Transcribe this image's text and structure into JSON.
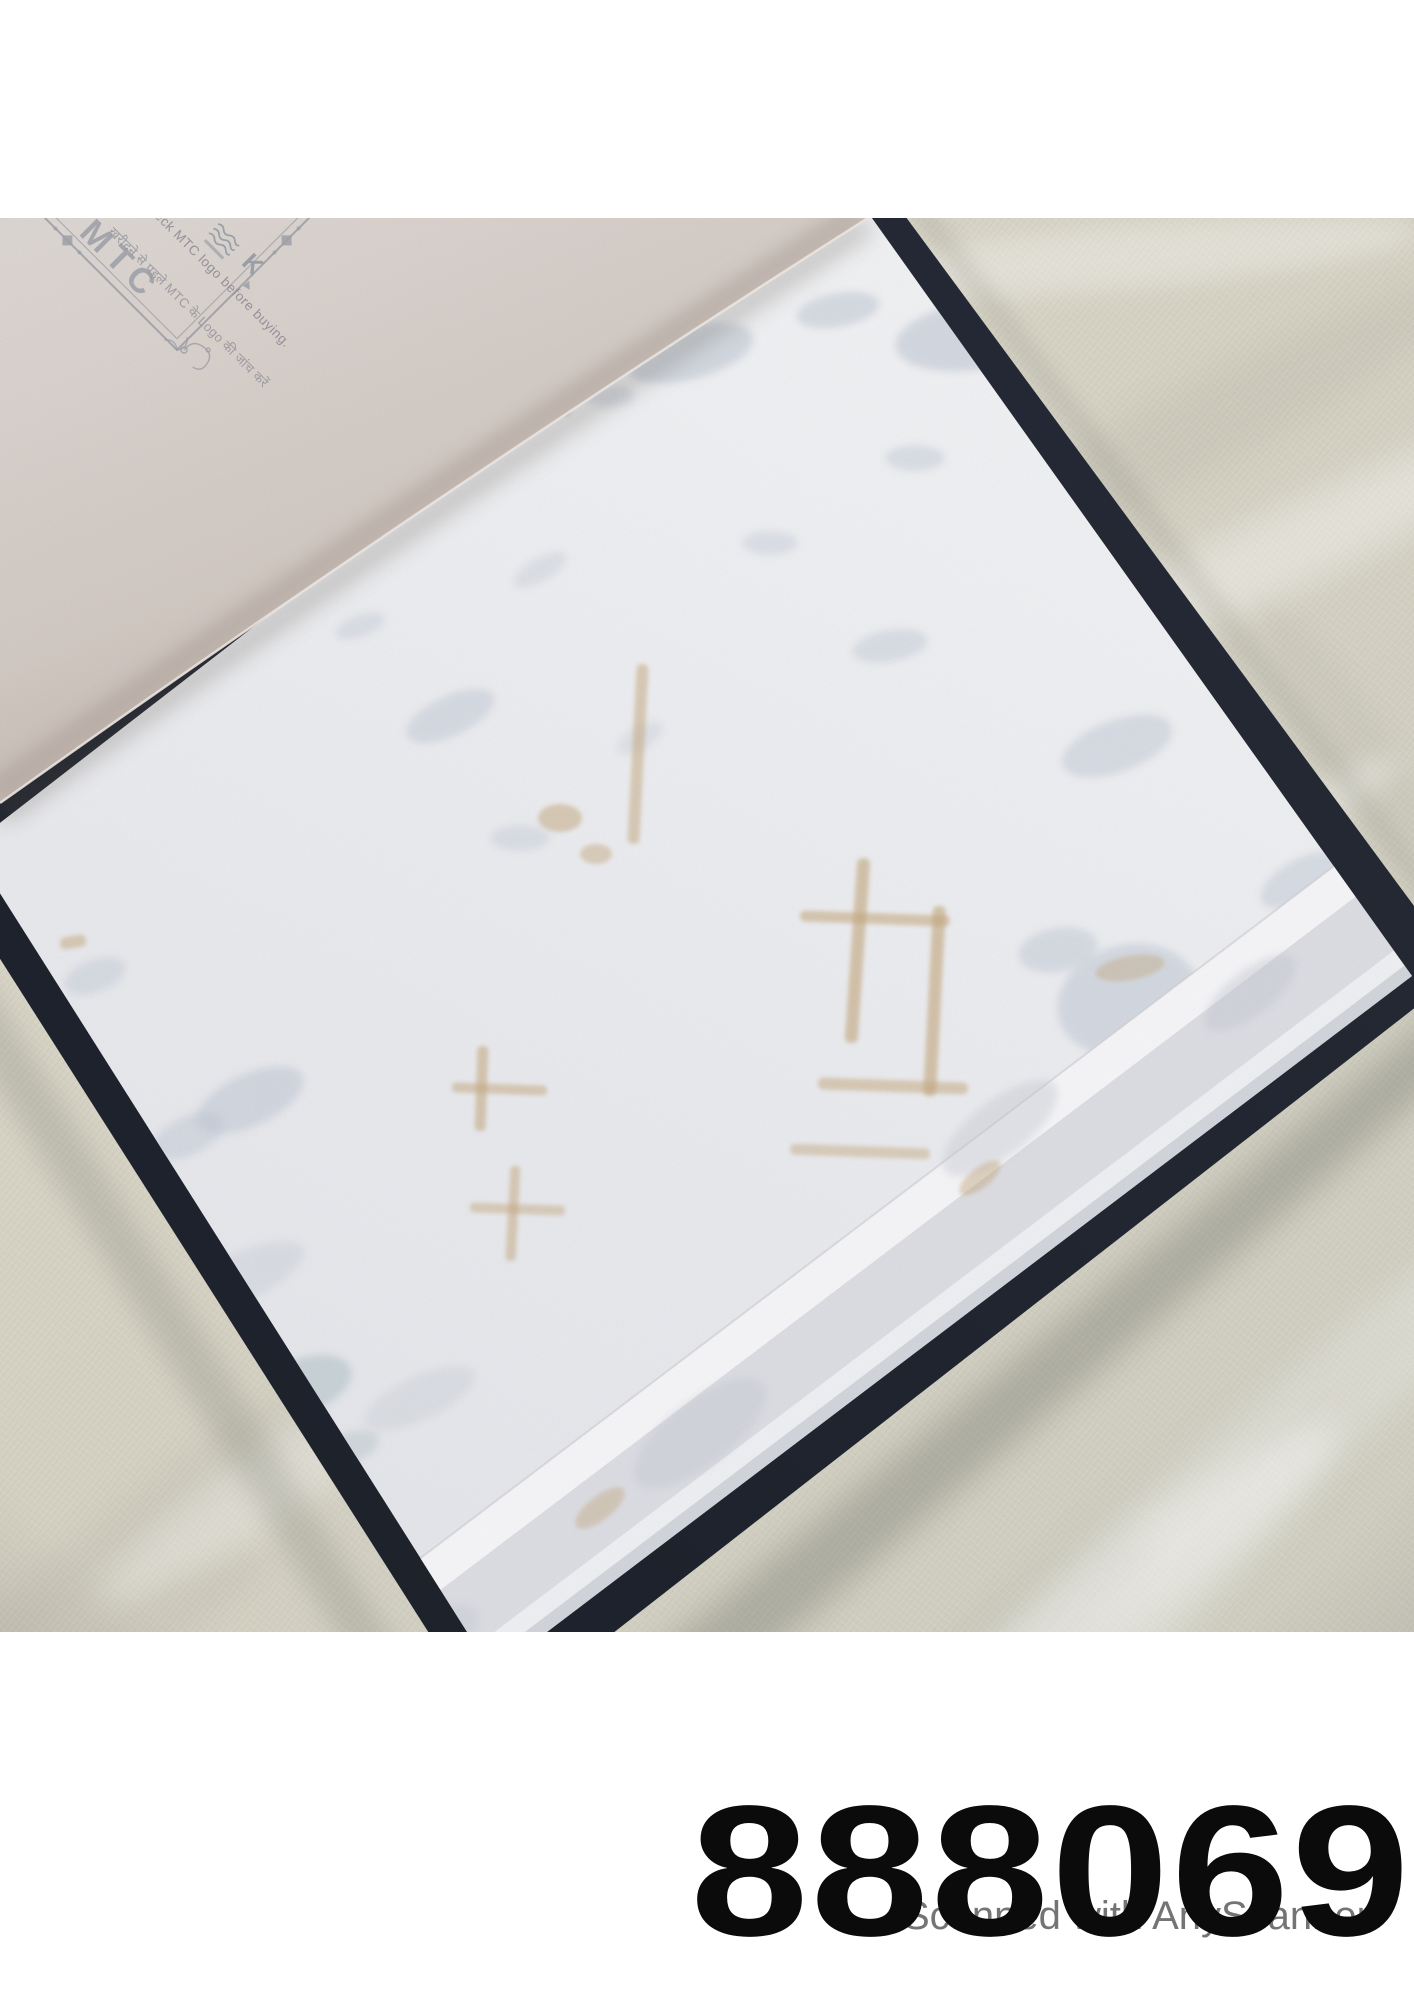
{
  "cover_page": {
    "brand": "MTC",
    "notice_en": "check MTC logo before buying.",
    "notice_hi": "खरीदने से पहले MTC के Logo की जांच करें",
    "k_mark": "K"
  },
  "footer": {
    "sample_number": "888069",
    "watermark": "Scanned with AnyScanner"
  },
  "colors": {
    "book_cover_navy": "#242834",
    "fabric_beige": "#d6d3c5",
    "sample_white": "#eaebee",
    "flipped_page_pink": "#d8d2cd",
    "accent_tan": "#c2a67c",
    "accent_silver": "#bfc7d3"
  }
}
